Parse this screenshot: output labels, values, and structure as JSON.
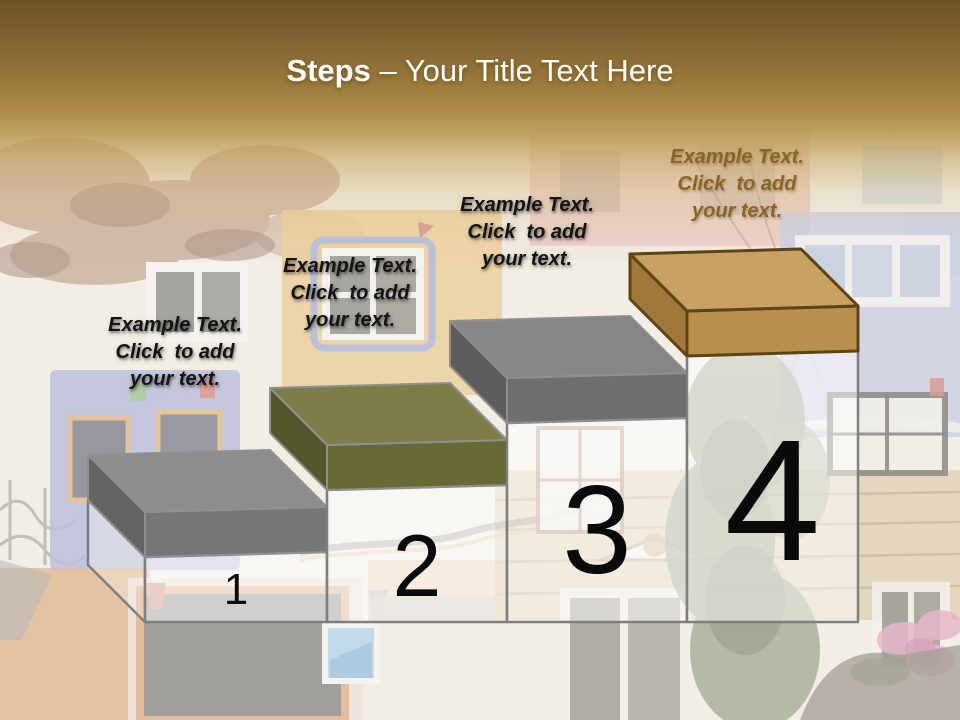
{
  "slide": {
    "title": {
      "prefix": "Steps",
      "suffix": " – Your Title Text Here"
    }
  },
  "placeholders": [
    {
      "lines": [
        "Example Text.",
        "Click  to add",
        "your text."
      ],
      "x": 175,
      "top": 312,
      "color": "#141414",
      "muted": false
    },
    {
      "lines": [
        "Example Text.",
        "Click  to add",
        "your text."
      ],
      "x": 350,
      "top": 253,
      "color": "#141414",
      "muted": false
    },
    {
      "lines": [
        "Example Text.",
        "Click  to add",
        "your text."
      ],
      "x": 527,
      "top": 192,
      "color": "#141414",
      "muted": false
    },
    {
      "lines": [
        "Example Text.",
        "Click  to add",
        "your text."
      ],
      "x": 737,
      "top": 144,
      "color": "#8a6526",
      "muted": true
    }
  ],
  "diagram": {
    "baseline_y": 622,
    "depth": 57,
    "lid_height": 45,
    "right_rise": 5,
    "outline_color": "#7f7f7f",
    "glass_fill": "rgba(255,255,255,0.50)",
    "glass_side_fill": "rgba(255,255,255,0.30)",
    "number_color": "#0a0a0a",
    "steps": [
      {
        "number": "1",
        "x_left": 145,
        "x_right": 327,
        "lid_top_y": 512,
        "number_font_px": 44,
        "number_baseline_y": 604,
        "colors": {
          "top": "#8d8d8d",
          "front": "#767676",
          "side": "#646464",
          "stroke": "#909090"
        }
      },
      {
        "number": "2",
        "x_left": 327,
        "x_right": 507,
        "lid_top_y": 445,
        "number_font_px": 88,
        "number_baseline_y": 596,
        "colors": {
          "top": "#7d7d48",
          "front": "#696936",
          "side": "#55552b",
          "stroke": "#8f8f8f"
        }
      },
      {
        "number": "3",
        "x_left": 507,
        "x_right": 687,
        "lid_top_y": 378,
        "number_font_px": 125,
        "number_baseline_y": 573,
        "colors": {
          "top": "#868686",
          "front": "#6f6f6f",
          "side": "#5d5d5d",
          "stroke": "#8f8f8f"
        }
      },
      {
        "number": "4",
        "x_left": 687,
        "x_right": 858,
        "lid_top_y": 311,
        "number_font_px": 173,
        "number_baseline_y": 560,
        "colors": {
          "top": "#c9a164",
          "front": "#b98f4e",
          "side": "#a1783a",
          "stroke": "#5e4414"
        }
      }
    ]
  }
}
